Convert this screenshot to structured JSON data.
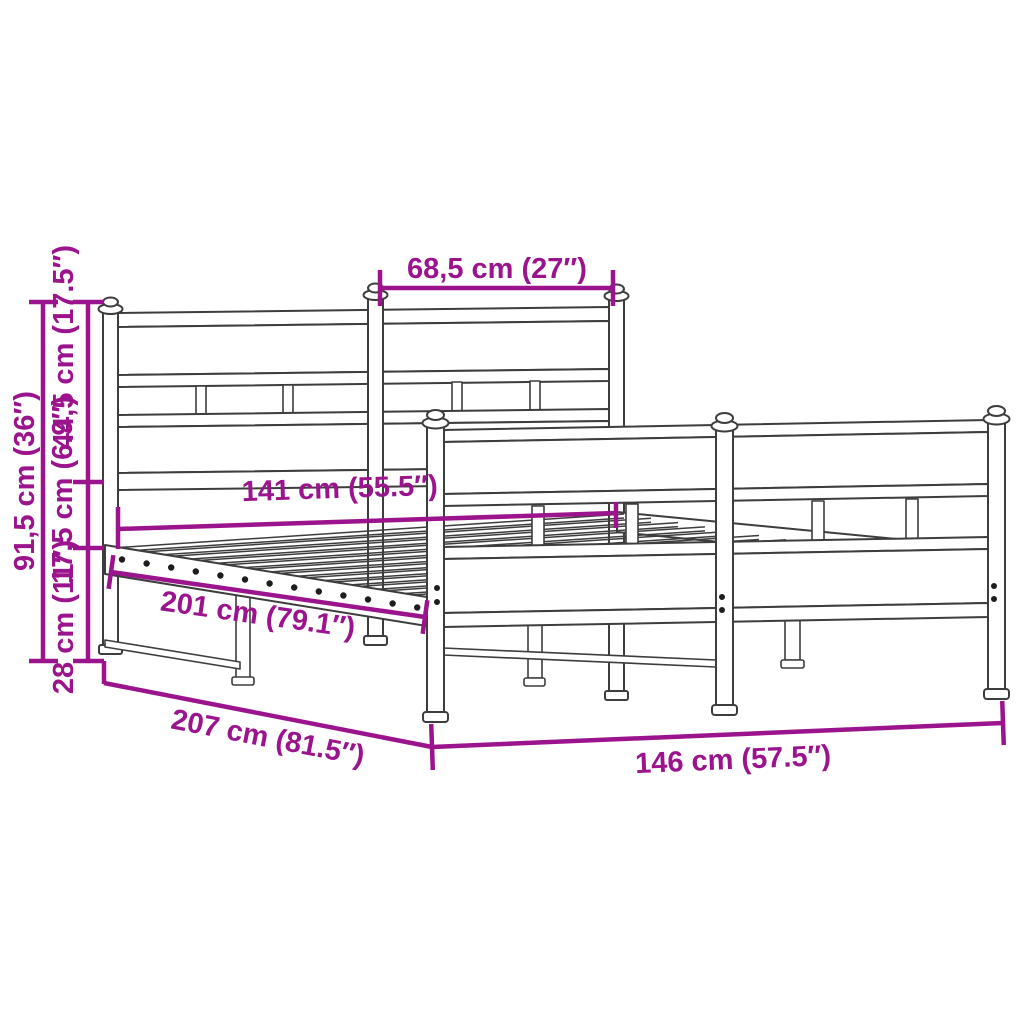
{
  "diagram": {
    "background_color": "#ffffff",
    "line_color": "#3d3d3d",
    "accent_color": "#9B148D",
    "dimensions": {
      "headboard_section_width": "68,5 cm (27″)",
      "headboard_total_height": "91,5 cm (36″)",
      "headboard_upper_height": "44,5 cm (17.5″)",
      "frame_side_height": "17,5 cm (6.9″)",
      "underbed_clearance_height": "28 cm (11″)",
      "inner_width": "141 cm (55.5″)",
      "inner_length": "201 cm (79.1″)",
      "outer_length": "207 cm (81.5″)",
      "outer_width": "146 cm (57.5″)"
    }
  }
}
